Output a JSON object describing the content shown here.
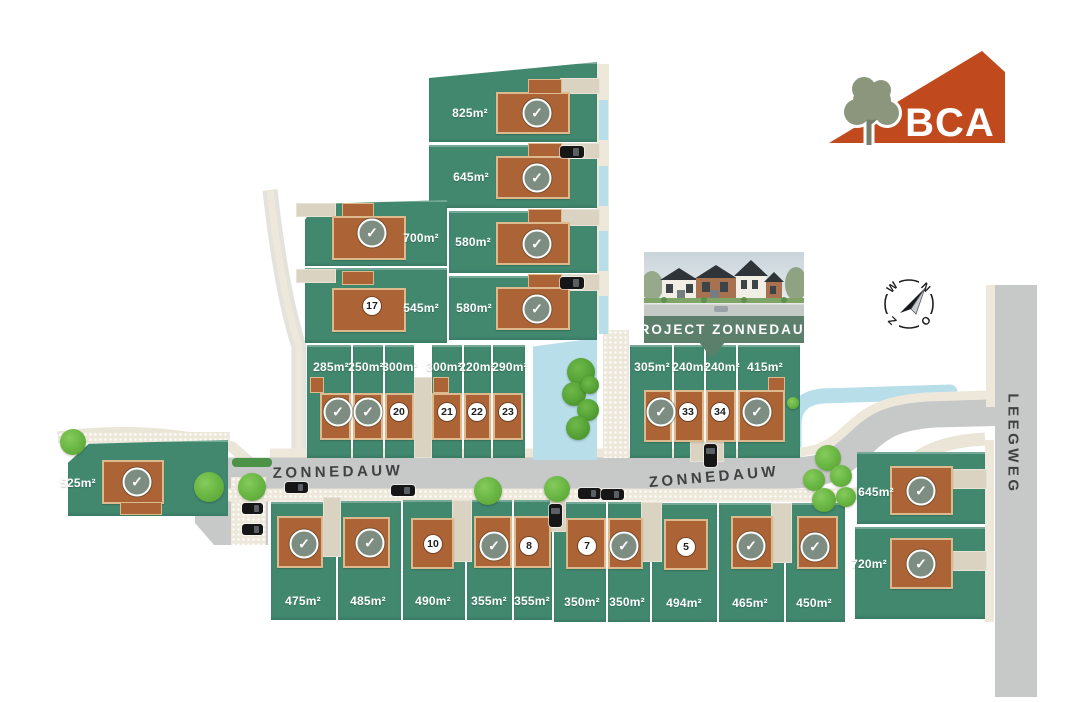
{
  "logo": {
    "text": "BCA"
  },
  "banner": {
    "label": "PROJECT ZONNEDAUW"
  },
  "compass": {
    "north": "N",
    "east": "O",
    "south": "Z",
    "west": "W"
  },
  "streets": {
    "zonnedauw_west": "ZONNEDAUW",
    "zonnedauw_east": "ZONNEDAUW",
    "leegweg": "LEEGWEG"
  },
  "icons": {
    "sold_check": "✓"
  },
  "colors": {
    "plot_green": "#41886F",
    "house_brown": "#AC6436",
    "road_gray": "#C7C8C8",
    "sidewalk_cream": "#EDE8DA",
    "water_blue": "#B7DEE9",
    "sold_badge_green": "#7E8D81",
    "banner_green": "#5C7F6C",
    "logo_orange": "#C04A1E",
    "tree_green": "#6CB845"
  },
  "plots": {
    "top_right": [
      {
        "area": "825m²",
        "status": "sold"
      },
      {
        "area": "645m²",
        "status": "sold"
      },
      {
        "area": "580m²",
        "status": "sold"
      },
      {
        "area": "580m²",
        "status": "sold"
      }
    ],
    "left_cluster": [
      {
        "area": "700m²",
        "status": "sold"
      },
      {
        "area": "545m²",
        "status": "available",
        "lot_number": "17"
      }
    ],
    "row_left": [
      {
        "area": "285m²",
        "status": "sold"
      },
      {
        "area": "250m²",
        "status": "sold"
      },
      {
        "area": "300m²",
        "status": "available",
        "lot_number": "20"
      },
      {
        "area": "300m²",
        "status": "available",
        "lot_number": "21"
      },
      {
        "area": "220m²",
        "status": "available",
        "lot_number": "22"
      },
      {
        "area": "290m²",
        "status": "available",
        "lot_number": "23"
      }
    ],
    "row_right": [
      {
        "area": "305m²",
        "status": "sold"
      },
      {
        "area": "240m²",
        "status": "available",
        "lot_number": "33"
      },
      {
        "area": "240m²",
        "status": "available",
        "lot_number": "34"
      },
      {
        "area": "415m²",
        "status": "sold"
      }
    ],
    "west": [
      {
        "area": "525m²",
        "status": "sold"
      }
    ],
    "east": [
      {
        "area": "645m²",
        "status": "sold"
      },
      {
        "area": "720m²",
        "status": "sold"
      }
    ],
    "bottom": [
      {
        "area": "475m²",
        "status": "sold"
      },
      {
        "area": "485m²",
        "status": "sold"
      },
      {
        "area": "490m²",
        "status": "available",
        "lot_number": "10"
      },
      {
        "area": "355m²",
        "status": "sold"
      },
      {
        "area": "355m²",
        "status": "available",
        "lot_number": "8"
      },
      {
        "area": "350m²",
        "status": "available",
        "lot_number": "7"
      },
      {
        "area": "350m²",
        "status": "sold"
      },
      {
        "area": "494m²",
        "status": "available",
        "lot_number": "5"
      },
      {
        "area": "465m²",
        "status": "sold"
      },
      {
        "area": "450m²",
        "status": "sold"
      }
    ]
  }
}
